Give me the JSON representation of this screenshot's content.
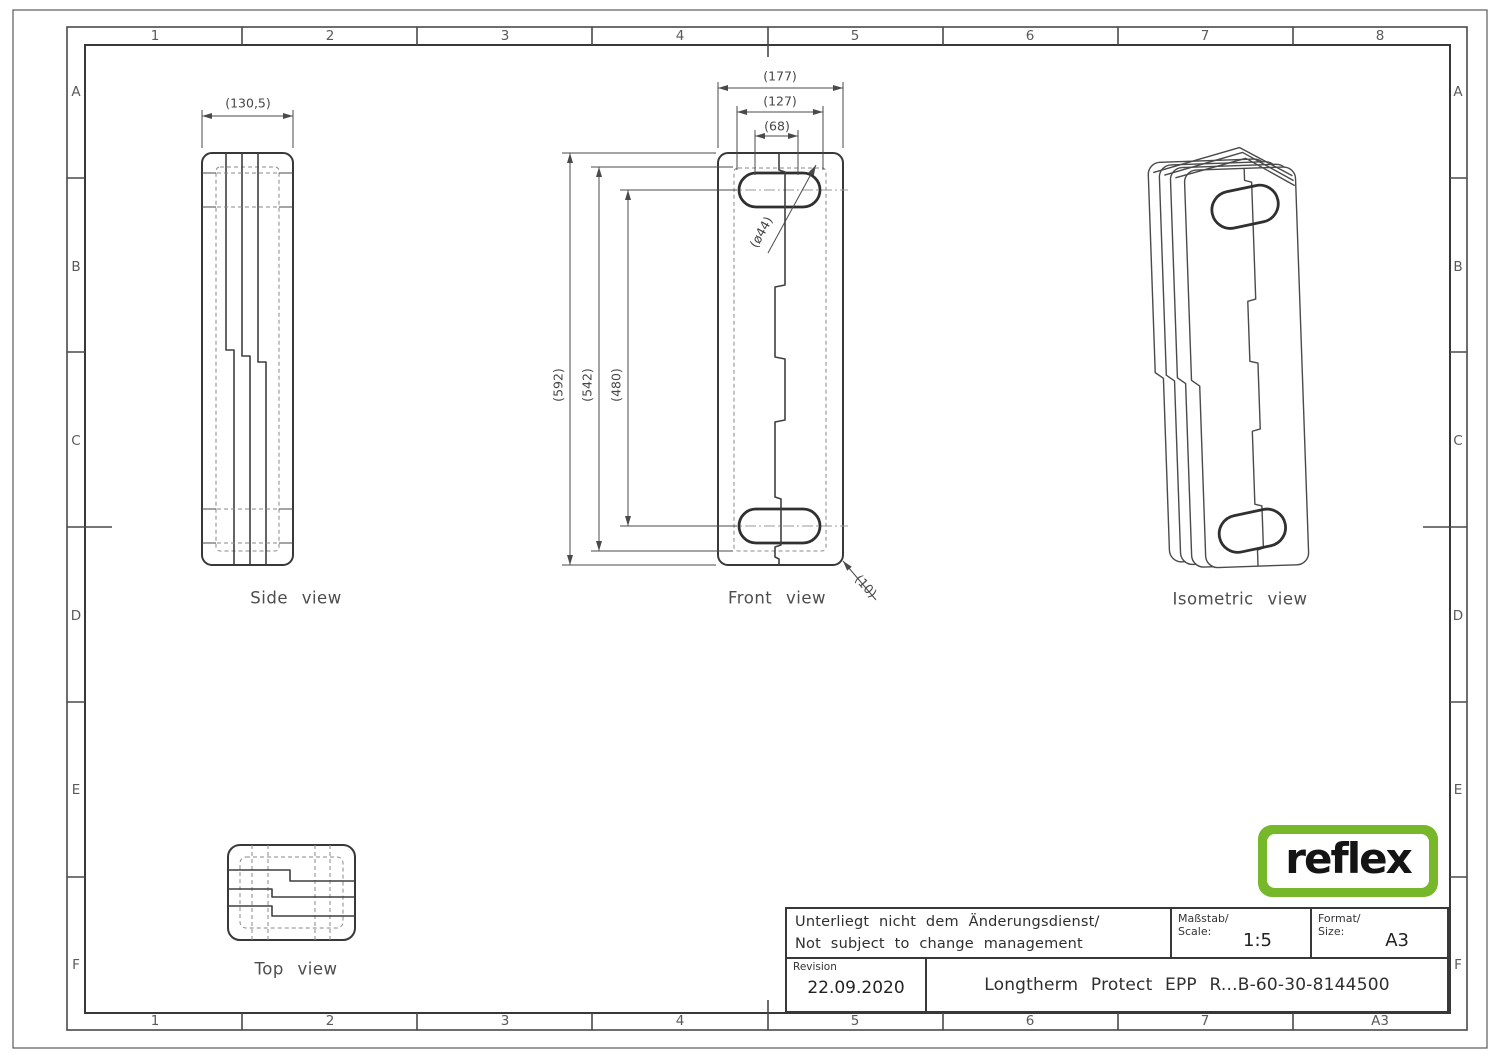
{
  "frame": {
    "top_columns": [
      "1",
      "2",
      "3",
      "4",
      "5",
      "6",
      "7",
      "8"
    ],
    "bottom_columns": [
      "1",
      "2",
      "3",
      "4",
      "5",
      "6",
      "7",
      "A3"
    ],
    "left_rows": [
      "A",
      "B",
      "C",
      "D",
      "E",
      "F"
    ],
    "right_rows": [
      "A",
      "B",
      "C",
      "D",
      "E",
      "F"
    ]
  },
  "views": {
    "side": {
      "label": "Side view",
      "dim_width": "(130,5)"
    },
    "front": {
      "label": "Front view",
      "dim_outer_width": "(177)",
      "dim_mid_width": "(127)",
      "dim_inner_width": "(68)",
      "dim_outer_height": "(592)",
      "dim_mid_height": "(542)",
      "dim_inner_height": "(480)",
      "dim_slot_diameter": "(ø44)",
      "dim_corner_radius": "(10)"
    },
    "isometric": {
      "label": "Isometric view"
    },
    "top": {
      "label": "Top view"
    }
  },
  "title_block": {
    "note_line1": "Unterliegt nicht dem Änderungsdienst/",
    "note_line2": "Not subject to change management",
    "scale_label_line1": "Maßstab/",
    "scale_label_line2": "Scale:",
    "scale_value": "1:5",
    "format_label_line1": "Format/",
    "format_label_line2": "Size:",
    "format_value": "A3",
    "revision_label": "Revision",
    "revision_date": "22.09.2020",
    "part_title": "Longtherm Protect EPP R...B-60-30-8144500"
  },
  "logo": {
    "text": "reflex",
    "green": "#76b82a"
  }
}
